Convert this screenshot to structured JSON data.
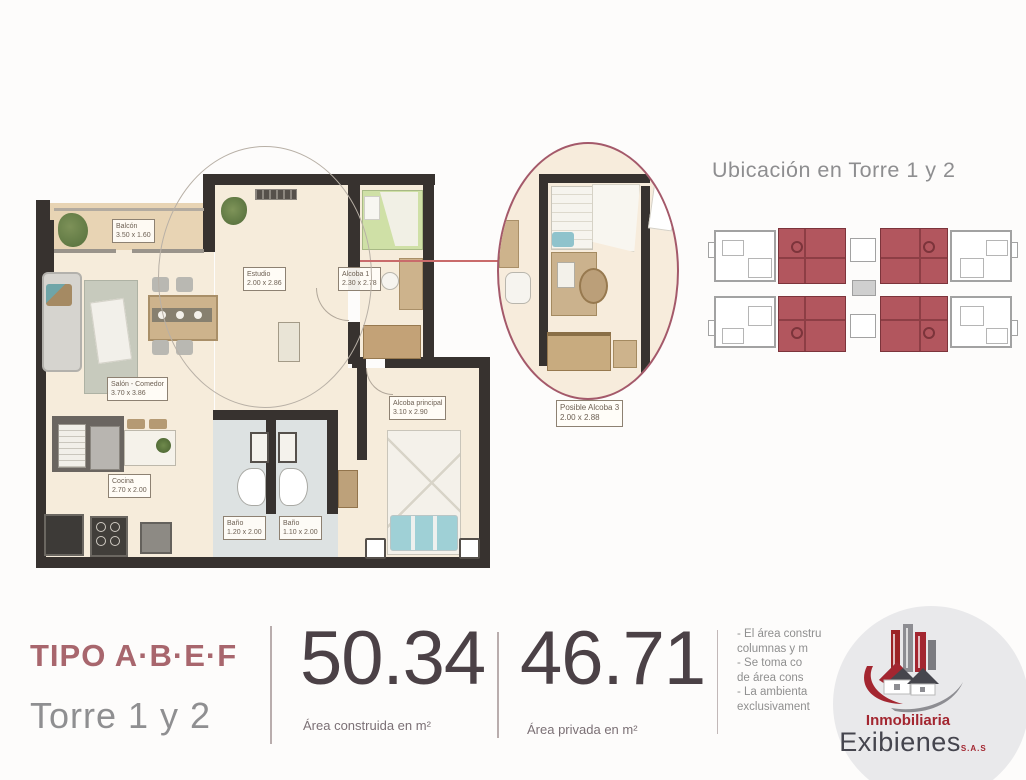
{
  "floor_plan": {
    "rooms": {
      "balcon": {
        "name": "Balcón",
        "dims": "3.50 x 1.60"
      },
      "estudio": {
        "name": "Estudio",
        "dims": "2.00 x 2.86"
      },
      "alcoba1": {
        "name": "Alcoba 1",
        "dims": "2.30 x 2.78"
      },
      "salon_comedor": {
        "name": "Salón - Comedor",
        "dims": "3.70 x 3.86"
      },
      "alcoba_principal": {
        "name": "Alcoba principal",
        "dims": "3.10 x 2.90"
      },
      "cocina": {
        "name": "Cocina",
        "dims": "2.70 x 2.00"
      },
      "bano1": {
        "name": "Baño",
        "dims": "1.20 x 2.00"
      },
      "bano2": {
        "name": "Baño",
        "dims": "1.10 x 2.00"
      }
    },
    "detail_callout": {
      "name": "Posible Alcoba 3",
      "dims": "2.00 x 2.88"
    }
  },
  "location_map": {
    "title": "Ubicación en Torre 1 y 2"
  },
  "summary": {
    "type_label": "TIPO A·B·E·F",
    "tower_label": "Torre 1 y 2",
    "built": {
      "value": "50.34",
      "caption": "Área construida en m²"
    },
    "private": {
      "value": "46.71",
      "caption": "Área privada en m²"
    },
    "disclaimer_lines": [
      "- El área constru",
      "columnas y m",
      "- Se toma co",
      "de área cons",
      "- La ambienta",
      "exclusivament"
    ]
  },
  "logo": {
    "line1": "Inmobiliaria",
    "line2": "Exibienes",
    "suffix": "S.A.S"
  },
  "colors": {
    "accent_rose": "#a8666d",
    "highlight_red": "#b2565e",
    "detail_ring": "#a4596a",
    "logo_red": "#a32630",
    "number_dark": "#4b4146",
    "wall_dark": "#37322f"
  }
}
